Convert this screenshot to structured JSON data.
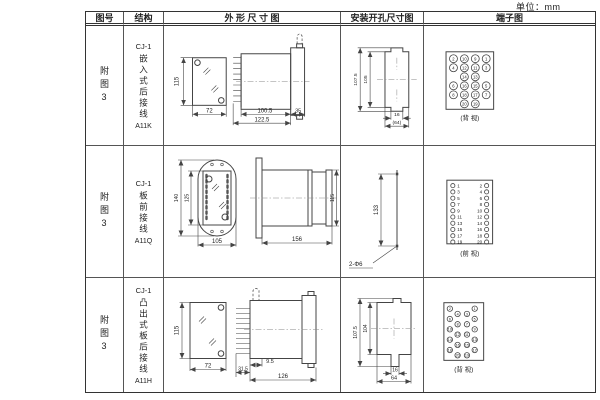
{
  "page": {
    "unit_label": "单位：mm"
  },
  "table": {
    "headers": [
      "图号",
      "结构",
      "外 形 尺 寸 图",
      "安装开孔尺寸图",
      "端子图"
    ]
  },
  "rows": [
    {
      "fig_no": "附图3",
      "structure_top": "CJ-1",
      "structure_chars": "嵌入式后接线",
      "model": "A11K",
      "outline": {
        "height": "115",
        "width": "72",
        "depth": "100.5",
        "flange": "35",
        "total_depth": "122.5"
      },
      "mounting": {
        "outer_height": "107.5",
        "inner_height": "105",
        "slot_width": "16",
        "opening_width": "(64)"
      },
      "terminal": {
        "pattern": "quad",
        "view_label": "(背 视)",
        "rows": [
          [
            2,
            10,
            9,
            1
          ],
          [
            4,
            12,
            11,
            3
          ],
          [
            14,
            13
          ],
          [
            6,
            16,
            15,
            5
          ],
          [
            8,
            18,
            17,
            7
          ],
          [
            20,
            19
          ]
        ]
      }
    },
    {
      "fig_no": "附图3",
      "structure_top": "CJ-1",
      "structure_chars": "板前接线",
      "model": "A11Q",
      "outline": {
        "outer_height": "140",
        "inner_height": "125",
        "width": "105",
        "depth": "156",
        "height": "115"
      },
      "mounting": {
        "hole_spacing": "133",
        "holes": "2-Φ6"
      },
      "terminal": {
        "pattern": "pairs",
        "view_label": "(前 视)",
        "rows": [
          [
            1,
            2
          ],
          [
            3,
            4
          ],
          [
            5,
            6
          ],
          [
            7,
            8
          ],
          [
            9,
            10
          ],
          [
            11,
            12
          ],
          [
            13,
            14
          ],
          [
            15,
            16
          ],
          [
            17,
            18
          ],
          [
            19,
            20
          ]
        ]
      }
    },
    {
      "fig_no": "附图3",
      "structure_top": "CJ-1",
      "structure_chars": "凸出式板后接线",
      "model": "A11H",
      "outline": {
        "height": "115",
        "width": "72",
        "pin_depth": "31.5",
        "gap": "9.5",
        "depth": "126"
      },
      "mounting": {
        "outer_height": "107.5",
        "inner_height": "104",
        "slot_width": "16",
        "opening_width": "64"
      },
      "terminal": {
        "pattern": "zigzag",
        "view_label": "(背 视)",
        "left": [
          2,
          4,
          6,
          8,
          10,
          12,
          14,
          16,
          18,
          20
        ],
        "right": [
          1,
          3,
          5,
          7,
          9,
          11,
          13,
          15,
          17,
          19
        ]
      }
    }
  ]
}
